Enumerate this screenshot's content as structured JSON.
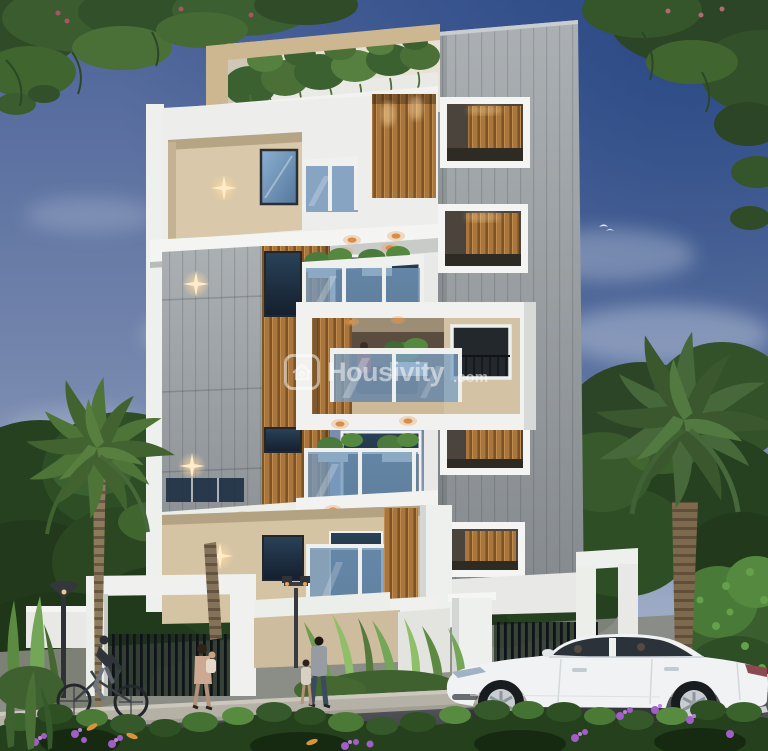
{
  "image": {
    "kind": "architectural-3d-render",
    "description": "Dusk exterior 3D rendering of a modern multi-storey residential apartment building with rooftop terrace plants, wooden slat panels, glass balconies, compound wall with gates, palm trees, pedestrians, a cyclist, a white sedan on the street and a flowering hedge in the foreground"
  },
  "watermark": {
    "brand": "Housivity",
    "tld": ".com",
    "icon": "housivity-house-logo-icon",
    "color": "#ffffff"
  },
  "palette": {
    "sky_deep": "#33518a",
    "sky_horizon": "#a9b6cd",
    "building_white": "#f1f2f0",
    "wall_beige": "#d5c4a4",
    "wall_gray": "#989ea2",
    "wood_slat": "#a8763e",
    "glass_blue": "#7498bc",
    "glass_dark": "#1b2836",
    "warm_light": "#e8a45c",
    "foliage_dark": "#26411f",
    "foliage_light": "#5c8440",
    "hedge_flower_purple": "#a05ec6",
    "road": "#45484c",
    "sidewalk": "#b6b1a7",
    "car_white": "#f0f2f4"
  },
  "scene_objects": [
    "sky-with-clouds",
    "tree-canopy-top-left",
    "tree-canopy-top-right",
    "apartment-building",
    "rooftop-terrace-plants",
    "wood-slat-panels",
    "glass-balconies",
    "star-wall-lights",
    "gray-panel-wall",
    "stair-tower-windows",
    "compound-wall-gates",
    "street-lamp",
    "garden-lamp",
    "palm-tree-left",
    "palm-tree-right",
    "white-sedan-car",
    "cyclist",
    "pedestrians",
    "foreground-hedge",
    "road-and-sidewalk"
  ]
}
